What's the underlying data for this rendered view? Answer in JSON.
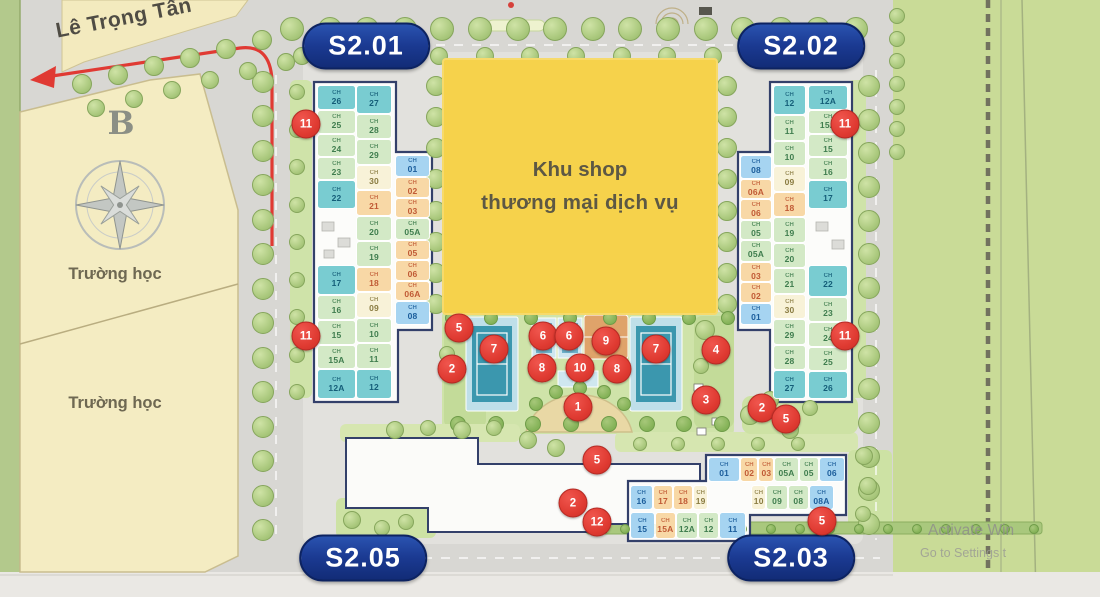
{
  "street_name": "Lê Trọng Tấn",
  "compass_letter": "B",
  "school_labels": [
    "Trường học",
    "Trường học"
  ],
  "shop_area": {
    "line1": "Khu shop",
    "line2": "thương mại dịch vụ"
  },
  "unit_prefix": "CH",
  "buildings": {
    "s201": {
      "label": "S2.01",
      "col_left_top": [
        {
          "no": "26",
          "c": "teal",
          "w": 1.1
        },
        {
          "no": "25",
          "c": "green",
          "w": 1
        },
        {
          "no": "24",
          "c": "green",
          "w": 1
        },
        {
          "no": "23",
          "c": "green",
          "w": 1
        },
        {
          "no": "22",
          "c": "teal",
          "w": 1.25
        }
      ],
      "col_left_bottom": [
        {
          "no": "17",
          "c": "teal",
          "w": 1.2
        },
        {
          "no": "16",
          "c": "green",
          "w": 1
        },
        {
          "no": "15",
          "c": "green",
          "w": 1
        },
        {
          "no": "15A",
          "c": "green",
          "w": 1
        },
        {
          "no": "12A",
          "c": "teal",
          "w": 1.2
        }
      ],
      "col_mid": [
        {
          "no": "27",
          "c": "teal",
          "w": 1.15
        },
        {
          "no": "28",
          "c": "green",
          "w": 1
        },
        {
          "no": "29",
          "c": "green",
          "w": 1
        },
        {
          "no": "30",
          "c": "cream",
          "w": 1
        },
        {
          "no": "21",
          "c": "orange",
          "w": 1
        },
        {
          "no": "20",
          "c": "green",
          "w": 1
        },
        {
          "no": "19",
          "c": "green",
          "w": 1
        },
        {
          "no": "18",
          "c": "orange",
          "w": 1
        },
        {
          "no": "09",
          "c": "cream",
          "w": 1
        },
        {
          "no": "10",
          "c": "green",
          "w": 1
        },
        {
          "no": "11",
          "c": "green",
          "w": 1
        },
        {
          "no": "12",
          "c": "teal",
          "w": 1.2
        }
      ],
      "col_right": [
        {
          "no": "01",
          "c": "blue",
          "w": 1.1
        },
        {
          "no": "02",
          "c": "orange",
          "w": 1
        },
        {
          "no": "03",
          "c": "orange",
          "w": 1
        },
        {
          "no": "05A",
          "c": "green",
          "w": 1.1
        },
        {
          "no": "05",
          "c": "orange",
          "w": 1
        },
        {
          "no": "06",
          "c": "orange",
          "w": 1
        },
        {
          "no": "06A",
          "c": "orange",
          "w": 1
        },
        {
          "no": "08",
          "c": "blue",
          "w": 1.2
        }
      ]
    },
    "s202": {
      "label": "S2.02",
      "col_left": [
        {
          "no": "08",
          "c": "blue",
          "w": 1.2
        },
        {
          "no": "06A",
          "c": "orange",
          "w": 1
        },
        {
          "no": "06",
          "c": "orange",
          "w": 1
        },
        {
          "no": "05",
          "c": "green",
          "w": 1
        },
        {
          "no": "05A",
          "c": "green",
          "w": 1.1
        },
        {
          "no": "03",
          "c": "orange",
          "w": 1
        },
        {
          "no": "02",
          "c": "orange",
          "w": 1
        },
        {
          "no": "01",
          "c": "blue",
          "w": 1.1
        }
      ],
      "col_mid": [
        {
          "no": "12",
          "c": "teal",
          "w": 1.2
        },
        {
          "no": "11",
          "c": "green",
          "w": 1
        },
        {
          "no": "10",
          "c": "green",
          "w": 1
        },
        {
          "no": "09",
          "c": "cream",
          "w": 1
        },
        {
          "no": "18",
          "c": "orange",
          "w": 1
        },
        {
          "no": "19",
          "c": "green",
          "w": 1
        },
        {
          "no": "20",
          "c": "green",
          "w": 1
        },
        {
          "no": "21",
          "c": "green",
          "w": 1
        },
        {
          "no": "30",
          "c": "cream",
          "w": 1
        },
        {
          "no": "29",
          "c": "green",
          "w": 1
        },
        {
          "no": "28",
          "c": "green",
          "w": 1
        },
        {
          "no": "27",
          "c": "teal",
          "w": 1.15
        }
      ],
      "col_right_top": [
        {
          "no": "12A",
          "c": "teal",
          "w": 1.1
        },
        {
          "no": "15A",
          "c": "green",
          "w": 1
        },
        {
          "no": "15",
          "c": "green",
          "w": 1
        },
        {
          "no": "16",
          "c": "green",
          "w": 1
        },
        {
          "no": "17",
          "c": "teal",
          "w": 1.25
        }
      ],
      "col_right_bottom": [
        {
          "no": "22",
          "c": "teal",
          "w": 1.35
        },
        {
          "no": "23",
          "c": "green",
          "w": 1
        },
        {
          "no": "24",
          "c": "green",
          "w": 1
        },
        {
          "no": "25",
          "c": "green",
          "w": 1
        },
        {
          "no": "26",
          "c": "teal",
          "w": 1.15
        }
      ]
    },
    "s203": {
      "label": "S2.03",
      "row_top": [
        {
          "no": "01",
          "c": "blue",
          "w": 1.5
        },
        {
          "no": "02",
          "c": "orange",
          "w": 0.8
        },
        {
          "no": "03",
          "c": "orange",
          "w": 0.7
        },
        {
          "no": "05A",
          "c": "green",
          "w": 1.1
        },
        {
          "no": "05",
          "c": "green",
          "w": 0.9
        },
        {
          "no": "06",
          "c": "blue",
          "w": 1.2
        }
      ],
      "row_mid_left": [
        {
          "no": "16",
          "c": "blue",
          "w": 1.15
        },
        {
          "no": "17",
          "c": "orange",
          "w": 1
        },
        {
          "no": "18",
          "c": "orange",
          "w": 1
        },
        {
          "no": "19",
          "c": "cream",
          "w": 0.7
        }
      ],
      "row_mid_right": [
        {
          "no": "10",
          "c": "cream",
          "w": 0.7
        },
        {
          "no": "09",
          "c": "green",
          "w": 1
        },
        {
          "no": "08",
          "c": "green",
          "w": 1
        },
        {
          "no": "08A",
          "c": "blue",
          "w": 1.2
        }
      ],
      "row_bottom": [
        {
          "no": "15",
          "c": "blue",
          "w": 1.15
        },
        {
          "no": "15A",
          "c": "orange",
          "w": 1
        },
        {
          "no": "12A",
          "c": "green",
          "w": 1
        },
        {
          "no": "12",
          "c": "green",
          "w": 1
        },
        {
          "no": "11",
          "c": "blue",
          "w": 1.25
        }
      ]
    },
    "s205": {
      "label": "S2.05"
    }
  },
  "markers": [
    {
      "n": "11",
      "x": 306,
      "y": 124
    },
    {
      "n": "11",
      "x": 845,
      "y": 124
    },
    {
      "n": "11",
      "x": 306,
      "y": 336
    },
    {
      "n": "11",
      "x": 845,
      "y": 336
    },
    {
      "n": "5",
      "x": 459,
      "y": 328
    },
    {
      "n": "2",
      "x": 452,
      "y": 369
    },
    {
      "n": "7",
      "x": 494,
      "y": 349
    },
    {
      "n": "6",
      "x": 543,
      "y": 336
    },
    {
      "n": "6",
      "x": 569,
      "y": 336
    },
    {
      "n": "9",
      "x": 606,
      "y": 341
    },
    {
      "n": "7",
      "x": 656,
      "y": 349
    },
    {
      "n": "8",
      "x": 542,
      "y": 368
    },
    {
      "n": "10",
      "x": 580,
      "y": 368
    },
    {
      "n": "8",
      "x": 617,
      "y": 369
    },
    {
      "n": "1",
      "x": 578,
      "y": 407
    },
    {
      "n": "4",
      "x": 716,
      "y": 350
    },
    {
      "n": "3",
      "x": 706,
      "y": 400
    },
    {
      "n": "2",
      "x": 762,
      "y": 408
    },
    {
      "n": "5",
      "x": 786,
      "y": 419
    },
    {
      "n": "5",
      "x": 597,
      "y": 460
    },
    {
      "n": "2",
      "x": 573,
      "y": 503
    },
    {
      "n": "12",
      "x": 597,
      "y": 522
    },
    {
      "n": "5",
      "x": 822,
      "y": 521
    }
  ],
  "watermark": {
    "line1": "Activate Win",
    "line2": "Go to Settings t"
  },
  "colors": {
    "pill_blue": "#1b3a92",
    "marker_red": "#df3a31",
    "shop_yellow": "#f6d24b",
    "unit_teal": "#79ccd1",
    "unit_green": "#d3e9c6",
    "unit_orange": "#f8d8a6",
    "unit_cream": "#f8f2d8",
    "unit_blue": "#a6d4f1",
    "parcel_cream": "#f4ecc2",
    "greenbelt": "#c9db97",
    "court_blue": "#3b97ae",
    "court_orange": "#dfa36a"
  }
}
